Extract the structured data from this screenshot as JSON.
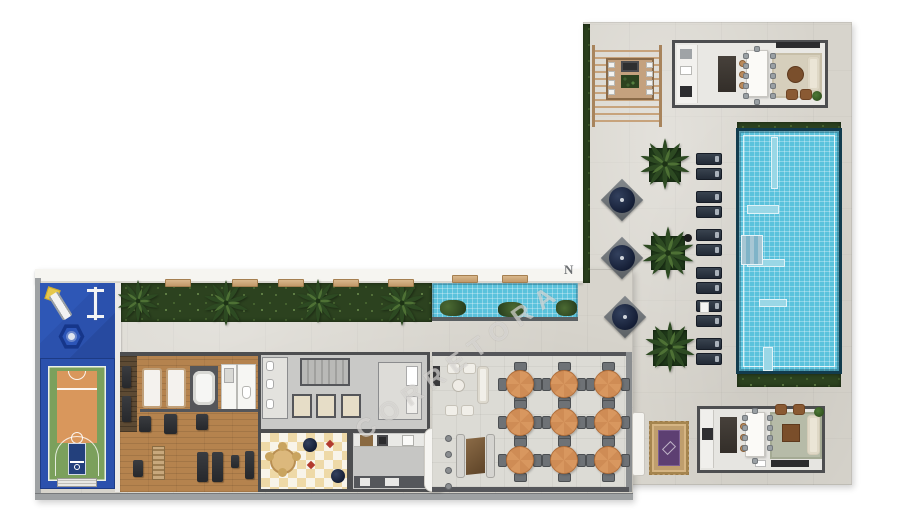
{
  "scene": {
    "type": "condominium amenities floor plan (top-down 3D render)",
    "background": "#ffffff"
  },
  "watermark": {
    "logo_letter": "N",
    "diagonal_text": "CORRETORA"
  },
  "palette": {
    "concrete": "#d7d4cc",
    "wall-dark": "#4d4e50",
    "wall-light": "#f6f5f1",
    "hedge": "#2c421f",
    "hedge2": "#4c6b33",
    "pool": "#5ac2dc",
    "pool-border": "#123c4e",
    "court-blue": "#2b51ad",
    "court-green": "#7ba05c",
    "court-orange": "#d9975c",
    "wood": "#b5834e",
    "table-wood": "#d8975f",
    "rug-sage": "#b6bba8",
    "rug-purple": "#5d3f72",
    "rug-border": "#bf9e6d",
    "cream": "#ebe5d6",
    "checker1": "#eed9a7",
    "checker2": "#f8f4e9",
    "floor-room": "#e9e8e4"
  },
  "inventory": {
    "main_pool_loungers": 12,
    "terrace_umbrellas": 3,
    "palm_trees": 7,
    "dining_tables": 9,
    "chairs_per_dining_table": 4,
    "elevators": 3,
    "areas": [
      "kids playground",
      "basketball court",
      "gym",
      "spa and showers",
      "building core with stairs and elevators",
      "kids playroom",
      "service kitchen",
      "covered dining terrace",
      "lounge seating",
      "bbq pergola",
      "gourmet kitchen and living",
      "party room",
      "planted water feature",
      "main swimming pool"
    ]
  }
}
